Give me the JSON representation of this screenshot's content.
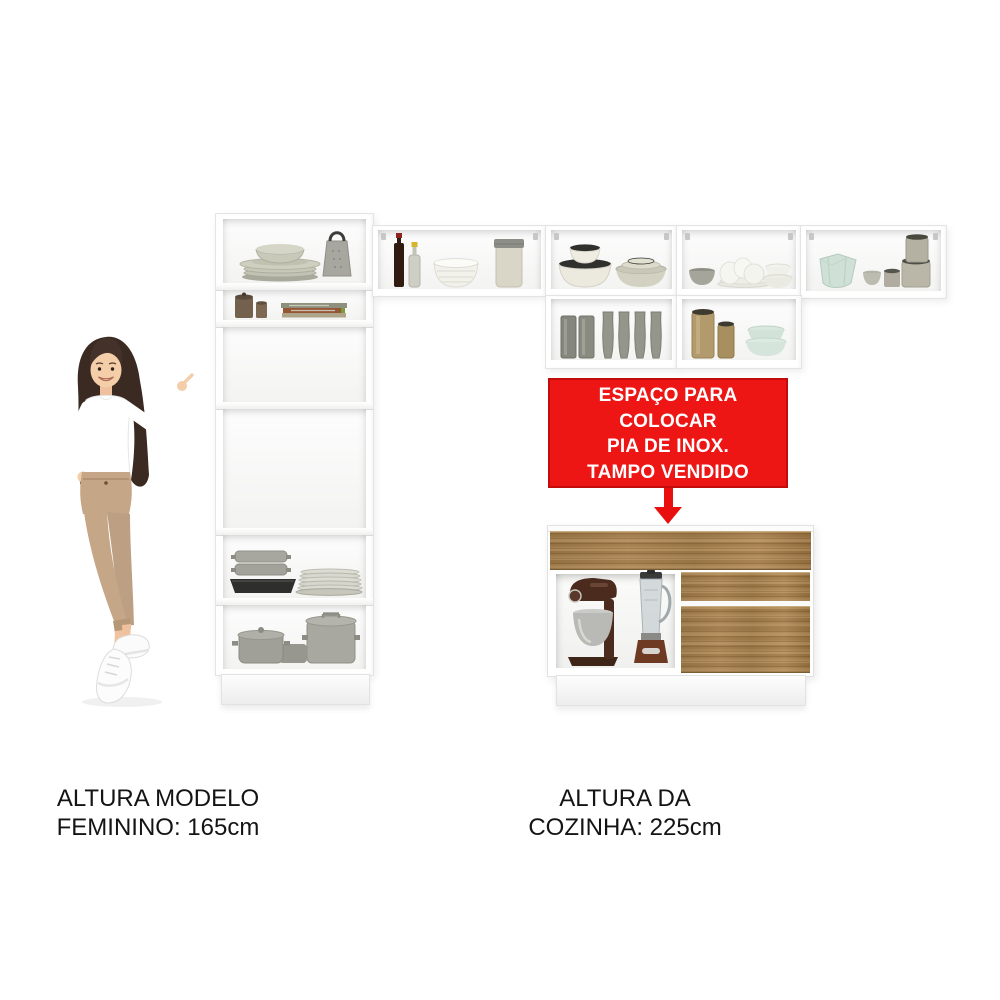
{
  "notice": {
    "lines": [
      "ESPAÇO PARA COLOCAR",
      "PIA DE INOX.",
      "TAMPO VENDIDO",
      "SEPARADAMENTE."
    ]
  },
  "captions": {
    "model_height": {
      "line1": "ALTURA MODELO",
      "line2": "FEMININO: 165cm"
    },
    "kitchen_height": {
      "line1": "ALTURA DA",
      "line2": "COZINHA: 225cm"
    }
  },
  "colors": {
    "notice_red": "#ee1515",
    "wood_brown": "#a9824f",
    "cabinet_white": "#ffffff",
    "text_black": "#141414"
  },
  "objects": {
    "model": "woman-pointing-at-cabinets",
    "tall_cabinet": [
      "stacked-plates-and-platter",
      "cheese-grater",
      "metal-canisters",
      "cookbook-stack",
      "empty-shelf",
      "empty-oven-space",
      "steamer-pans",
      "black-roasting-pan",
      "plate-stack",
      "lidded-pot",
      "saucepan",
      "stockpot"
    ],
    "upper_cabinets": [
      "wine-bottle",
      "oil-bottle",
      "white-ribbed-bowl",
      "storage-jar",
      "dark-rim-bowl-stack",
      "sage-bowl-stack",
      "small-gray-bowl",
      "white-dishes-cluster",
      "white-bowl-stack",
      "mint-faceted-bowls",
      "cup-and-bowl",
      "canister-stack",
      "smoked-glass-tumblers",
      "shaped-goblets",
      "gold-canisters",
      "mint-bowl-stack"
    ],
    "sink_cabinet": [
      "stand-mixer",
      "blender",
      "wood-drawer",
      "wood-door"
    ]
  }
}
